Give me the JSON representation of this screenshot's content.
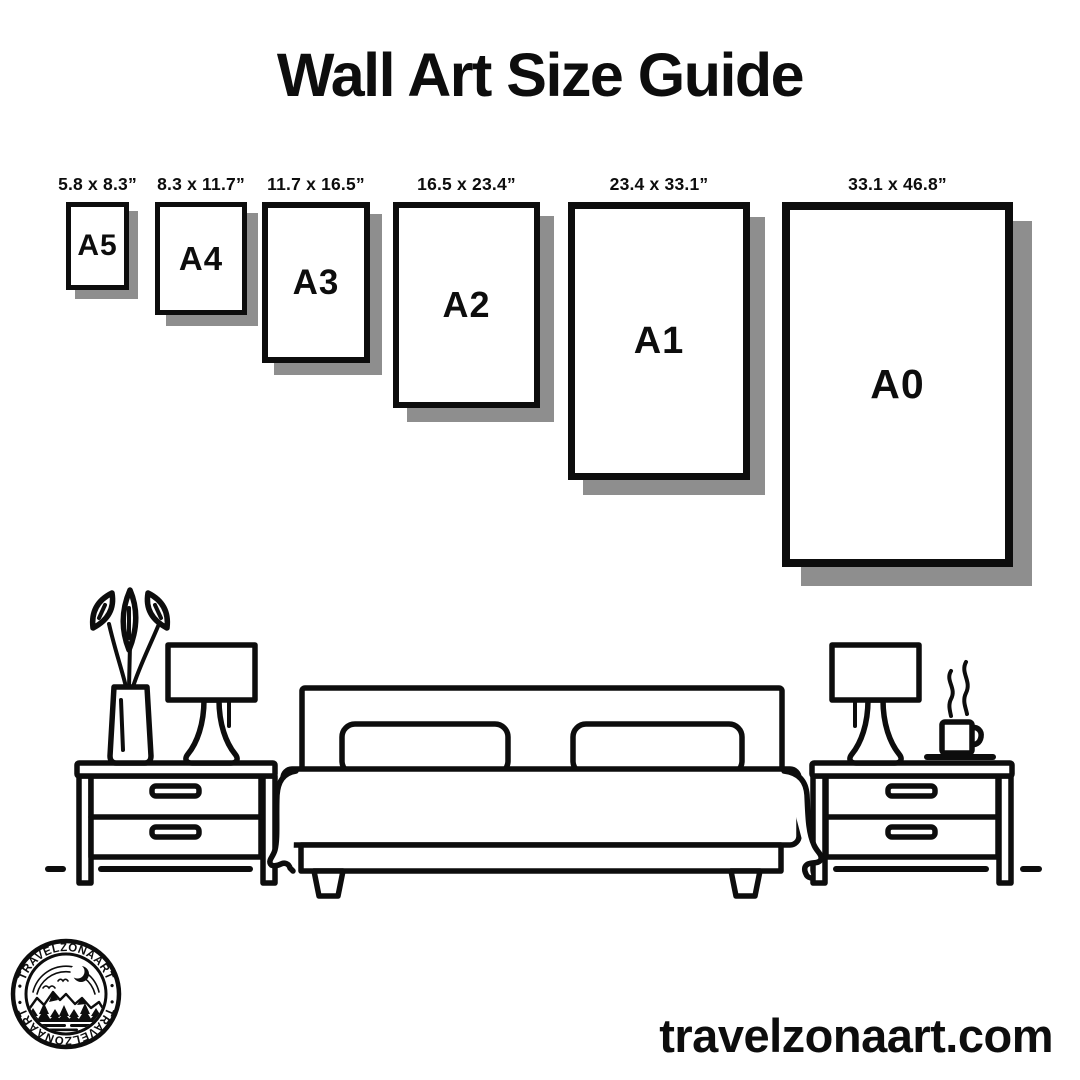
{
  "title": "Wall Art Size Guide",
  "sizes": [
    {
      "code": "A5",
      "dimensions": "5.8 x 8.3”"
    },
    {
      "code": "A4",
      "dimensions": "8.3 x 11.7”"
    },
    {
      "code": "A3",
      "dimensions": "11.7 x 16.5”"
    },
    {
      "code": "A2",
      "dimensions": "16.5 x 23.4”"
    },
    {
      "code": "A1",
      "dimensions": "23.4 x 33.1”"
    },
    {
      "code": "A0",
      "dimensions": "33.1 x 46.8”"
    }
  ],
  "logo": {
    "arc_text_top": "• TRAVELZONAART •",
    "arc_text_bottom": "• TRAVELZONAART •"
  },
  "footer": {
    "website": "travelzonaart.com"
  },
  "colors": {
    "ink": "#0d0d0d",
    "shadow": "#8e8e8e",
    "background": "#ffffff"
  }
}
